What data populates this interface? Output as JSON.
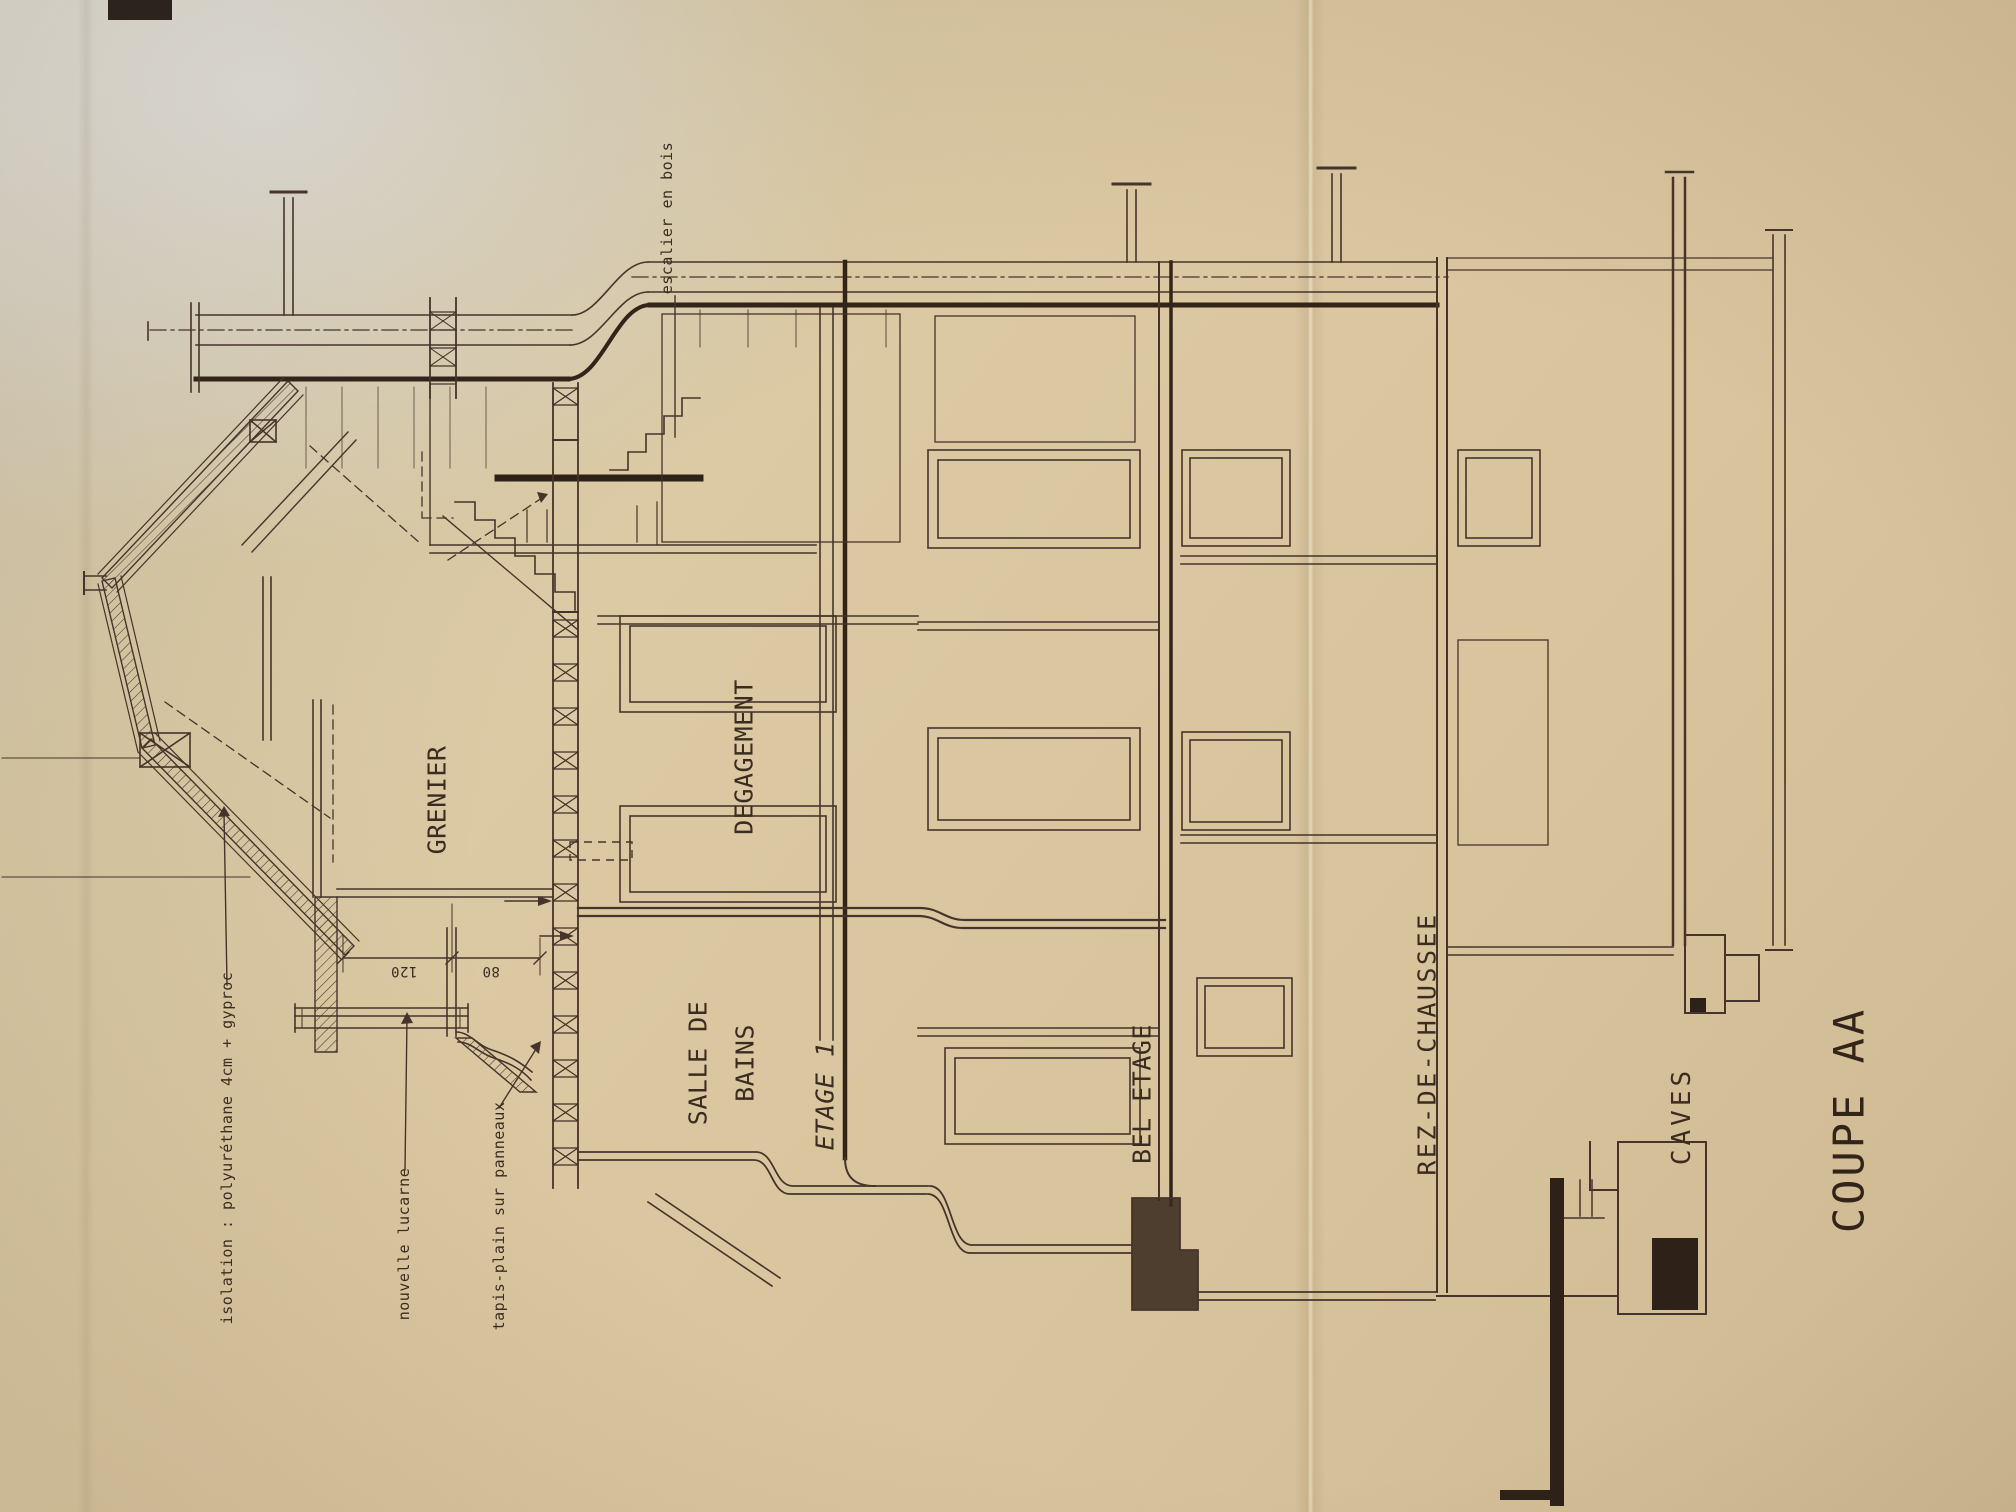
{
  "drawing": {
    "title": "COUPE AA",
    "rooms": {
      "grenier": "GRENIER",
      "degagement": "DEGAGEMENT",
      "salle_de_bains_line1": "SALLE DE",
      "salle_de_bains_line2": "BAINS",
      "etage_1": "ETAGE 1",
      "bel_etage": "BEL ETAGE",
      "rez_de_chaussee": "REZ-DE-CHAUSSEE",
      "caves": "CAVES"
    },
    "annotations": {
      "escalier": "escalier en bois",
      "isolation": "isolation : polyuréthane 4cm + gyproc",
      "lucarne": "nouvelle lucarne",
      "tapis": "tapis-plain sur panneaux"
    },
    "dimensions": {
      "lucarne_width": "120",
      "lucarne_side": "80"
    },
    "colors": {
      "paper": "#d8c7a5",
      "ink": "#46342a",
      "ink_heavy": "#2e2118"
    }
  }
}
